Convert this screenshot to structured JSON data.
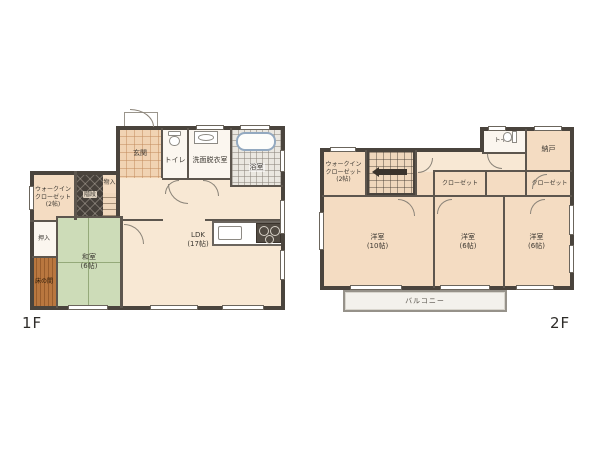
{
  "title": {
    "floor1": "1F",
    "floor2": "2F"
  },
  "floor1": {
    "genkan": "玄関",
    "toilet": "トイレ",
    "washroom": "洗面脱衣室",
    "bathroom": "浴室",
    "wic": "ウォークイン\nクローゼット\n(2帖)",
    "stairs": "階段",
    "monoire": "物入",
    "oshiire": "押入",
    "tokonoma": "床の間",
    "washitsu": "和室\n(6帖)",
    "ldk": "LDK\n(17帖)"
  },
  "floor2": {
    "toilet": "トイレ",
    "nando": "納戸",
    "wic": "ウォークイン\nクローゼット\n(2帖)",
    "closet1": "クローゼット",
    "closet2": "クローゼット",
    "bedroom1": "洋室\n(10帖)",
    "bedroom2": "洋室\n(6帖)",
    "bedroom3": "洋室\n(6帖)",
    "balcony": "バルコニー"
  },
  "colors": {
    "wall": "#4a443d",
    "floor_main": "#f4dcc2",
    "tatami_green": "#cddcb8",
    "tokonoma_wood": "#b9773f",
    "bath_tile": "#eae7e0",
    "balcony": "#f3f1ec",
    "bathtub_outline": "#93a9c0"
  }
}
